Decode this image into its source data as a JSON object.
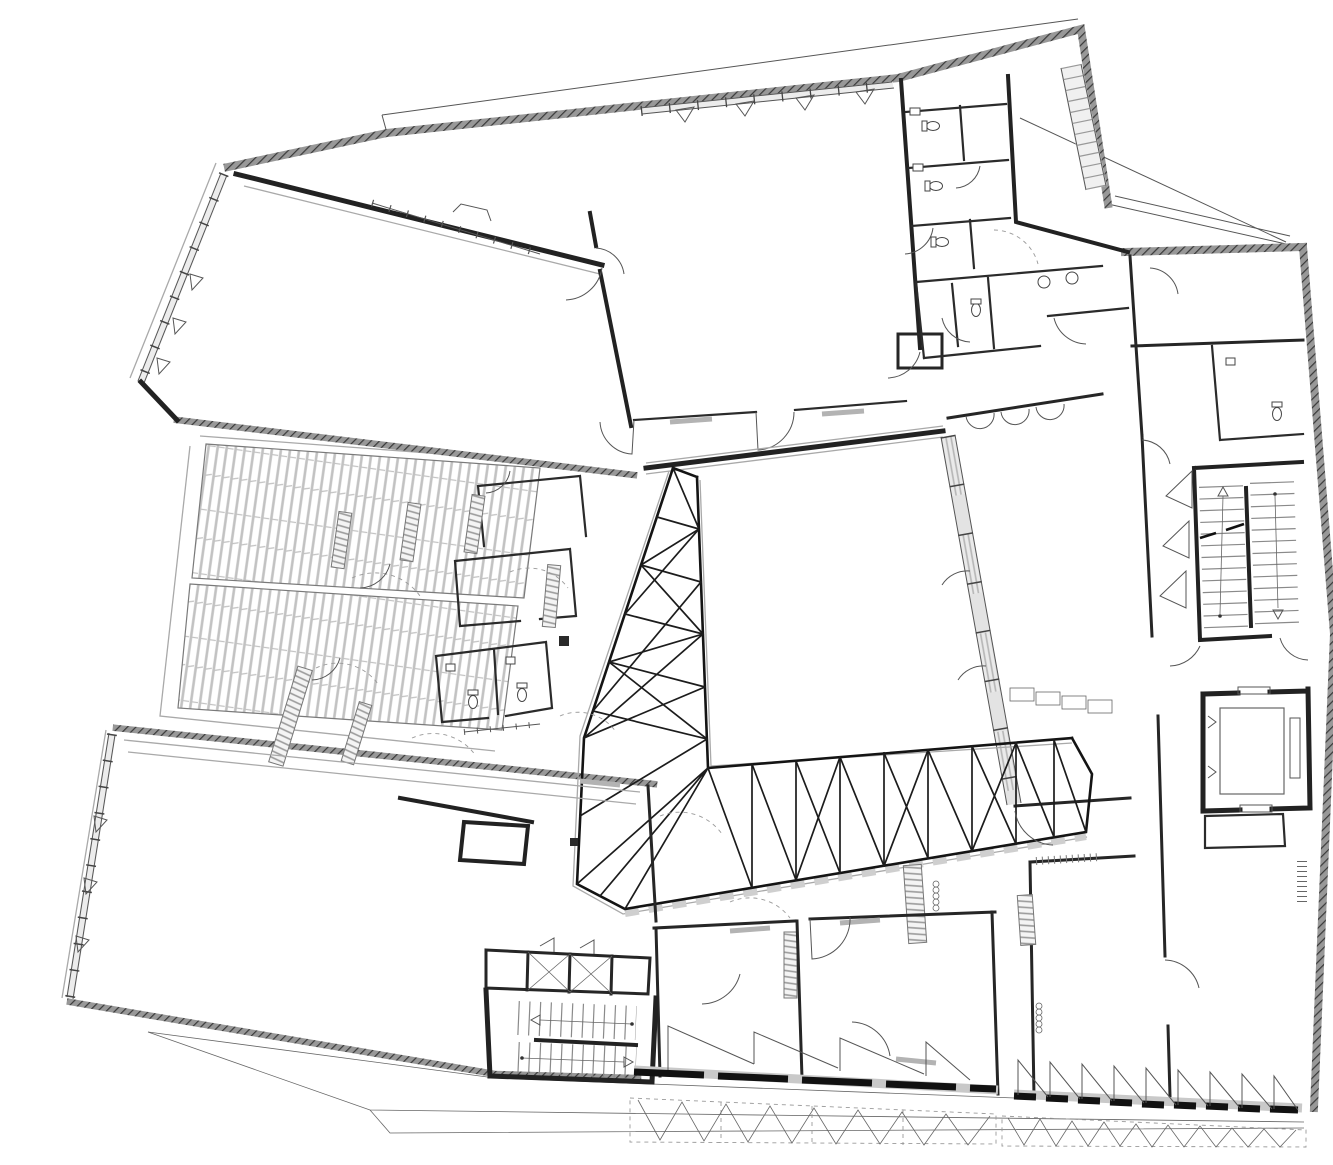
{
  "document": {
    "kind": "architectural floor plan",
    "view": "ground floor plan, monochrome CAD linework on white",
    "visible_text_labels": []
  },
  "palette": {
    "background": "#ffffff",
    "wall_black": "#222222",
    "exterior_wall_hatch_grey": "#989898",
    "exterior_wall_hatch_line": "#3a3a3a",
    "thin_line": "#555555",
    "grey_line": "#a9a9a9",
    "plank_hatch": "#c2c2c2",
    "bench_stripe": "#9b9b9b",
    "glazing_fill": "#ececec",
    "tread_grey": "#8a8a8a"
  },
  "features": {
    "wings": [
      "upper-left hall with glazed west facade",
      "top-centre hall with glazed north facade",
      "top-right sanitary cluster with chamfered corner",
      "east wing with stair, WC, corridor and elevator",
      "central hall wrapped by L-shaped triangulated truss",
      "left cluster of small rooms with striped benches",
      "two plank-hatched terraces on the west side",
      "large bottom-left hall with glazed west facade",
      "south rooms with switchback stair and pivoting facade panels"
    ],
    "atrium_truss": {
      "left_band_bays": 6,
      "bottom_band_bays": 8
    },
    "stairs": [
      {
        "name": "east-switchback-stair",
        "flights": 2,
        "direction_arrows": 2
      },
      {
        "name": "south-switchback-stair",
        "flights": 2,
        "direction_arrows": 2
      }
    ],
    "elevator": {
      "count": 1,
      "guide_rail_marks": 2
    },
    "terraces": {
      "count": 2,
      "hatch": "plank"
    },
    "facade_pivot_panels": {
      "south_west_group": 4,
      "south_east_group": 9,
      "swing_zone_chevrons": 18
    },
    "window_opening_triangles": {
      "west_facade": 3,
      "north_facade": 4,
      "bottom_left_facade": 3
    },
    "wc_fixtures": {
      "toilets": 8,
      "sinks": 6
    },
    "site_boundary_lines": 3,
    "sight_line_diagonal": 1
  }
}
